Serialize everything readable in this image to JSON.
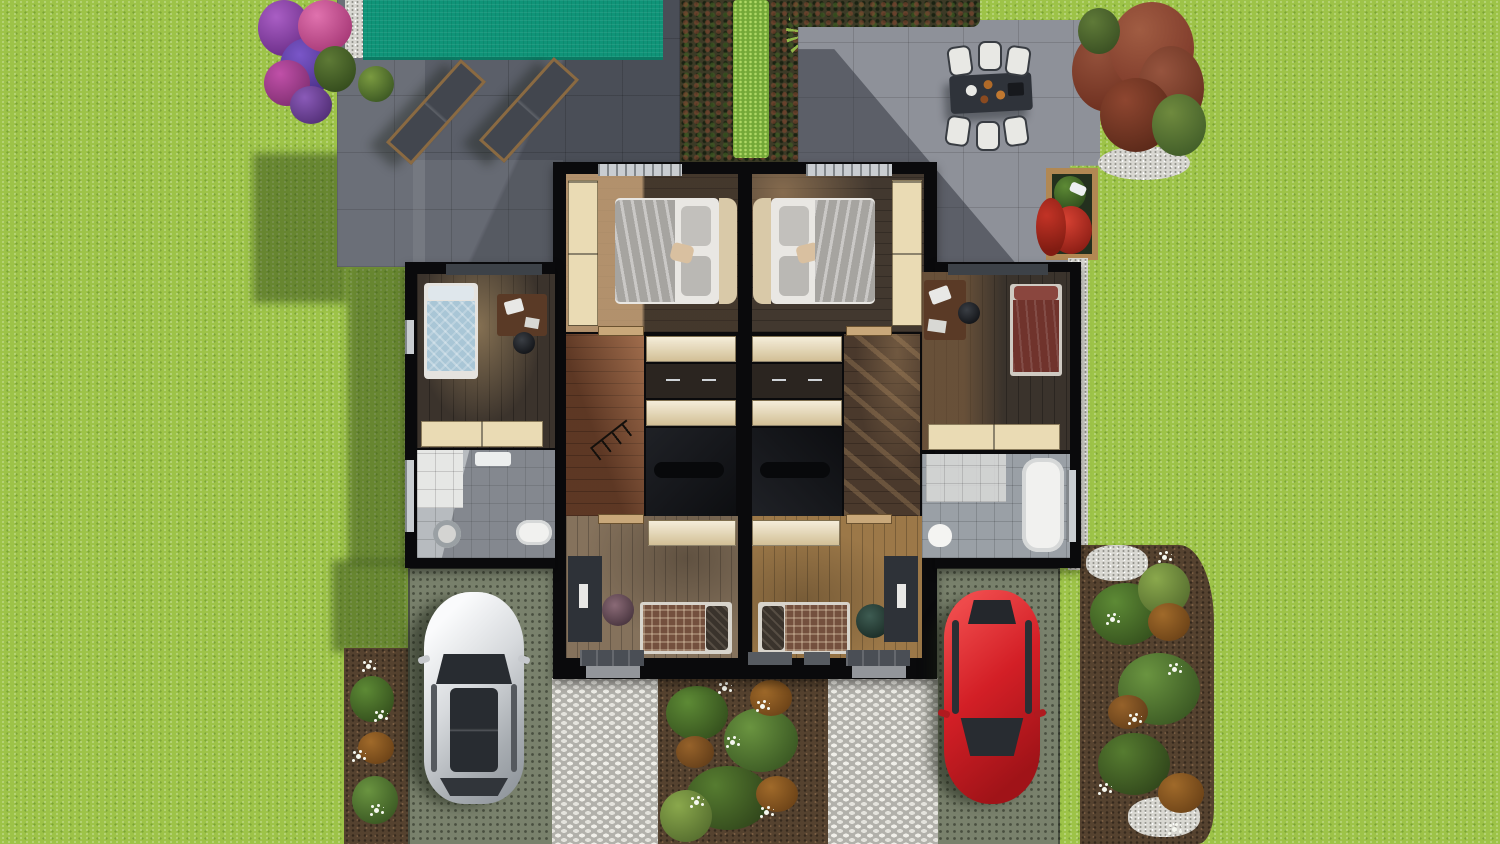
{
  "scene": {
    "type": "3d-aerial-floor-plan-render",
    "description": "Top-down 3D render of a semi-detached duplex upper floor cutaway with two mirrored units, swimming pool terrace with two sun loungers, outdoor dining patio with six chairs, hedge screen, two grass-paver driveways with a white car and a red car, cobblestone walkways and planted borders on a lawn",
    "units": [
      {
        "name": "left-unit",
        "rooms": [
          "master-bedroom",
          "kids-bedroom-blue",
          "bathroom",
          "hallway-with-stairs",
          "office-guest-room"
        ]
      },
      {
        "name": "right-unit",
        "rooms": [
          "master-bedroom",
          "kids-bedroom-red",
          "bathroom",
          "hallway-with-stairs",
          "office-guest-room"
        ]
      }
    ],
    "exterior_objects": [
      "lawn",
      "swimming-pool",
      "pool-terrace",
      "sun-lounger-left",
      "sun-lounger-right",
      "hedge-screen",
      "palm-plant",
      "dining-patio",
      "dining-table",
      "dining-chairs-x6",
      "red-leaf-shrub",
      "purple-flower-bush",
      "flower-planter-box",
      "gravel-strip",
      "driveway-left",
      "driveway-right",
      "white-car",
      "red-car",
      "walkway-left",
      "walkway-right",
      "planting-bed-left",
      "planting-bed-center",
      "planting-bed-right"
    ]
  },
  "theme": {
    "grass": "#9dc348",
    "grassShadow": "#587a28",
    "poolWater": "#0f9478",
    "terraceDark": "#5b5f69",
    "terraceLight": "#8e9199",
    "wall": "#0a0a0c",
    "cabinet": "#eadbb4",
    "driveway": "#79816c",
    "gravel": "#d8d7d1",
    "mulch": "#55422f",
    "cobble": "#eae9e3",
    "carWhite": "#d9dadc",
    "carRed": "#d01f26",
    "glassDark": "#282c31",
    "bedWhite": "#e9e7e3",
    "bedBlue": "#a9c6d6",
    "bedRedBlanket": "#70332c",
    "plaidBlanket": "#74503e",
    "hedgeBright": "#74a838",
    "flowerPurple": "#8f49ac",
    "flowerPink": "#d55f9e",
    "bushRed": "#8e4630",
    "planterWood": "#b18853",
    "planterFlower": "#c23326"
  }
}
